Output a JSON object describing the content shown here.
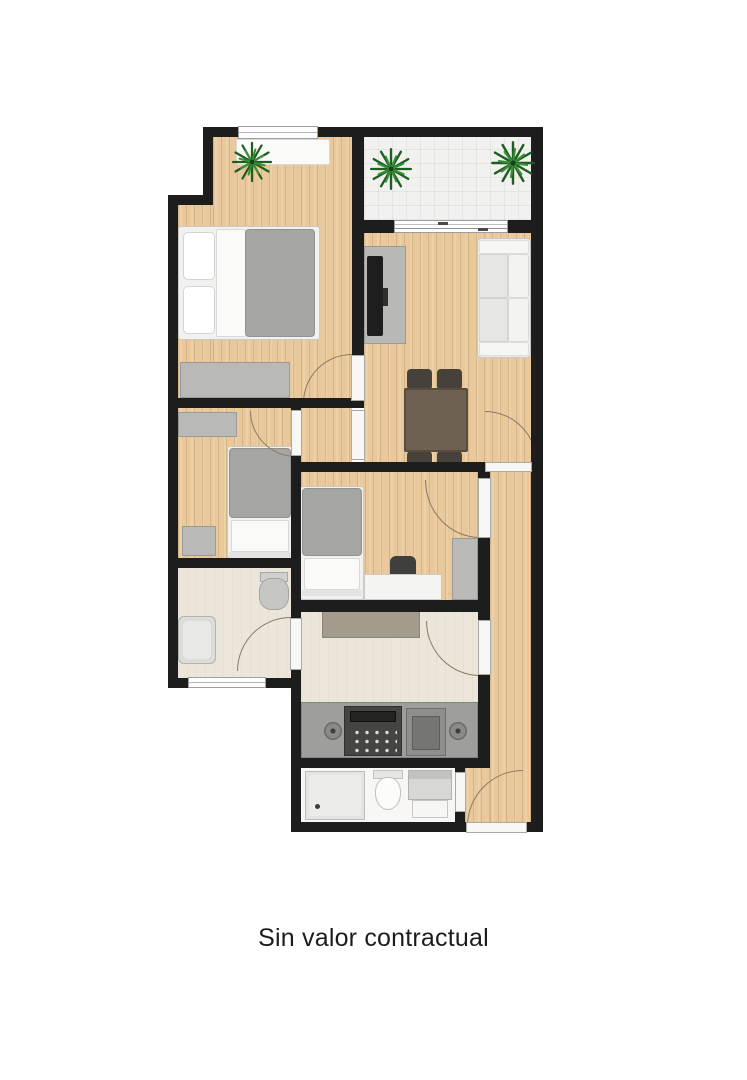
{
  "caption": {
    "text": "Sin valor contractual"
  },
  "palette": {
    "background": "#ffffff",
    "wall": "#1d1d1d",
    "wood": "#e9c99b",
    "tile": "#f1f1ef",
    "cream": "#ece6da",
    "bath_floor": "#f8f7f5",
    "furniture": "#b9b9b7",
    "duvet": "#a5a5a3",
    "table_brown": "#6e6154",
    "chair_dark": "#46413a",
    "counter": "#9e9e9c",
    "appliance_dark": "#454543",
    "plant": "#2a7230",
    "door_arc": "#8a7a66",
    "text": "#1c1c1c"
  },
  "floorplan": {
    "regions": [
      "bedroom-1",
      "balcony",
      "living-dining-room",
      "hall",
      "bedroom-2",
      "bedroom-3",
      "bathroom-1",
      "kitchen",
      "bathroom-2",
      "corridor"
    ],
    "furniture": [
      "double-bed",
      "single-bed",
      "single-bed",
      "sofa",
      "tv-unit",
      "dining-table",
      "dining-chairs",
      "desk",
      "desk-chair",
      "wardrobe",
      "dresser",
      "shelf",
      "nightstand",
      "bathtub",
      "toilet",
      "toilet",
      "shower",
      "sink-vanity",
      "kitchen-counter",
      "stove",
      "oven",
      "kitchen-table"
    ],
    "plants": 3,
    "doors": 7,
    "windows": 3
  }
}
